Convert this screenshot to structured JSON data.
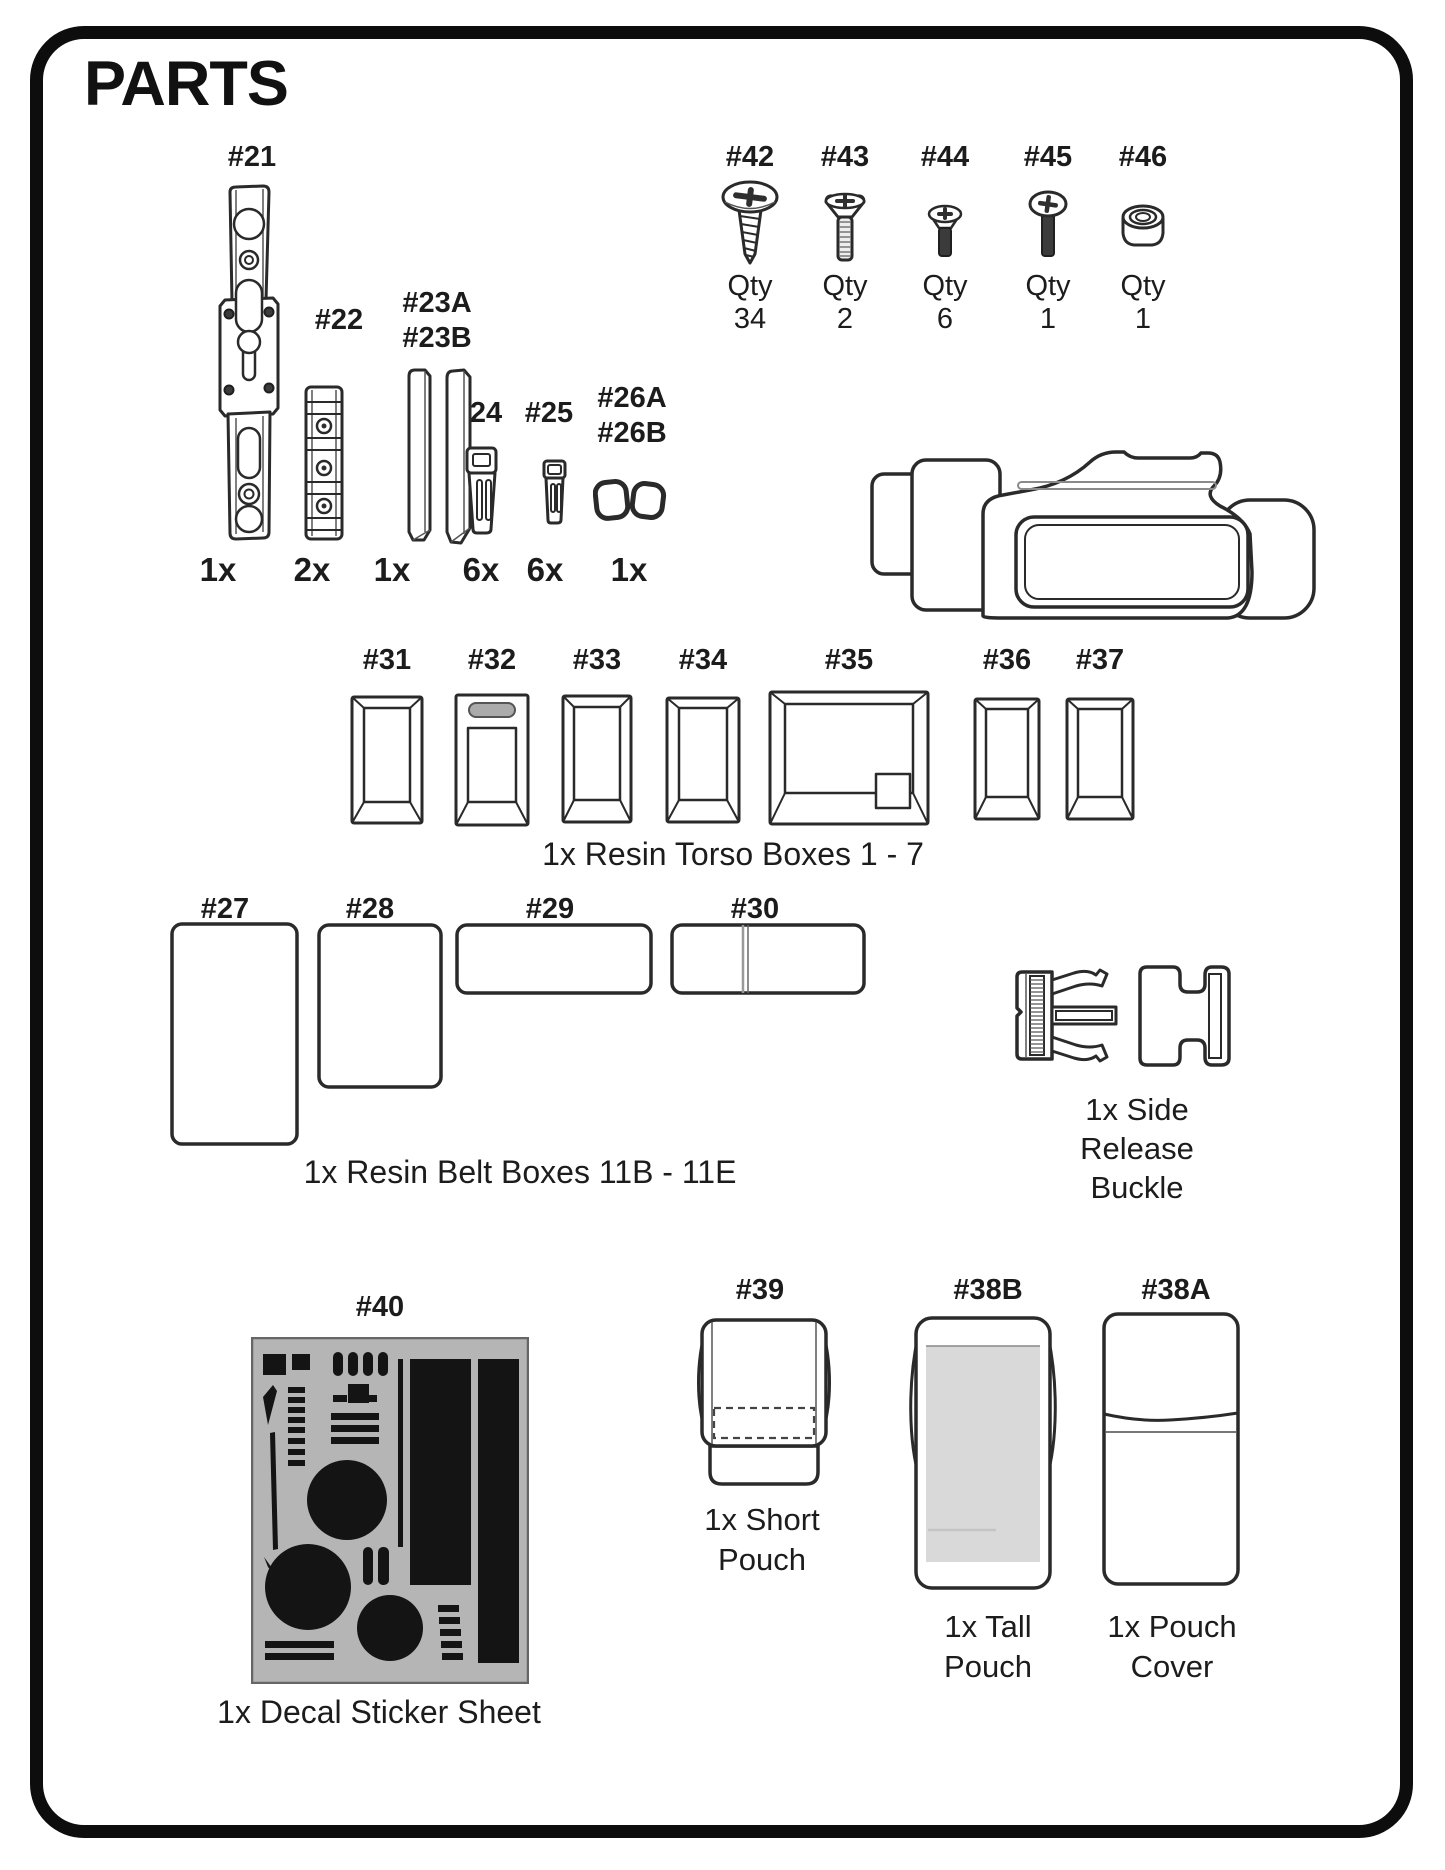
{
  "title": "PARTS",
  "colors": {
    "ink": "#1c1c1c",
    "border": "#0d0d0d",
    "decal_sheet_gray": "#b5b5b5",
    "decal_shape_black": "#141414",
    "slot_gray": "#ababab",
    "pouch_interior_gray": "#d9d9d9",
    "screw_dark": "#3b3b3b"
  },
  "small_parts": [
    {
      "labels": [
        "#21"
      ],
      "qty": "1x"
    },
    {
      "labels": [
        "#22"
      ],
      "qty": "2x"
    },
    {
      "labels": [
        "#23A",
        "#23B"
      ],
      "qty": "1x"
    },
    {
      "labels": [
        "#24"
      ],
      "qty": "6x"
    },
    {
      "labels": [
        "#25"
      ],
      "qty": "6x"
    },
    {
      "labels": [
        "#26A",
        "#26B"
      ],
      "qty": "1x"
    }
  ],
  "fasteners": [
    {
      "label": "#42",
      "qty_label": "Qty",
      "qty_value": "34"
    },
    {
      "label": "#43",
      "qty_label": "Qty",
      "qty_value": "2"
    },
    {
      "label": "#44",
      "qty_label": "Qty",
      "qty_value": "6"
    },
    {
      "label": "#45",
      "qty_label": "Qty",
      "qty_value": "1"
    },
    {
      "label": "#46",
      "qty_label": "Qty",
      "qty_value": "1"
    }
  ],
  "torso_boxes": {
    "labels": [
      "#31",
      "#32",
      "#33",
      "#34",
      "#35",
      "#36",
      "#37"
    ],
    "caption": "1x Resin Torso Boxes 1 - 7"
  },
  "belt_boxes": {
    "labels": [
      "#27",
      "#28",
      "#29",
      "#30"
    ],
    "caption": "1x Resin Belt Boxes 11B - 11E"
  },
  "buckle": {
    "caption_lines": [
      "1x Side",
      "Release",
      "Buckle"
    ]
  },
  "decal_sheet": {
    "label": "#40",
    "caption": "1x Decal Sticker Sheet"
  },
  "pouches": {
    "short": {
      "label": "#39",
      "caption_lines": [
        "1x Short",
        "Pouch"
      ]
    },
    "tall": {
      "label": "#38B",
      "caption_lines": [
        "1x Tall",
        "Pouch"
      ]
    },
    "cover": {
      "label": "#38A",
      "caption_lines": [
        "1x Pouch",
        "Cover"
      ]
    }
  }
}
